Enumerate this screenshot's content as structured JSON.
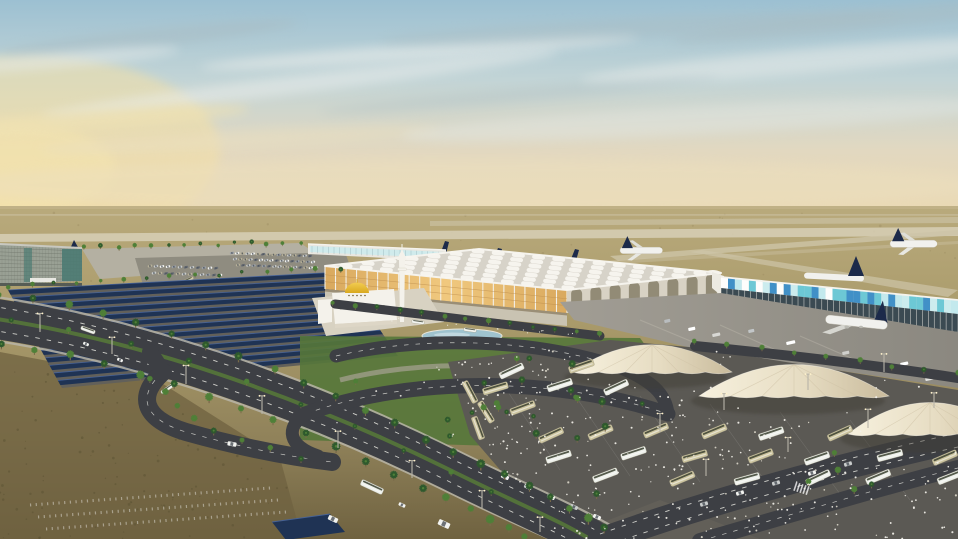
{
  "scene": {
    "description": "Aerial dusk rendering of a new airport complex: large terminal with skylight-grid roof, golden-domed mosque, glass concourses with parked airliners, solar carport parking field, white fabric tent canopies, bus terminal crowded with pilgrims, and palm-lined boulevards through desert terrain",
    "landmarks": [
      "sky",
      "desert",
      "runways",
      "hotel-building",
      "northwest-concourse",
      "main-terminal",
      "terminal-skylight-roof",
      "mosque",
      "minaret",
      "east-concourse",
      "apron",
      "aircraft",
      "solar-carport-field",
      "tent-canopies",
      "bus-terminal",
      "boulevard",
      "palm-trees",
      "pilgrim-crowds",
      "pond"
    ],
    "counts": {
      "tents": 3,
      "aircraft_full": 3,
      "aircraft_tail_fins": 4,
      "solar_rows": 13,
      "skylight_rows": 7,
      "skylight_cols": 12,
      "mosaic_cells": 34,
      "facade_columns": 24,
      "arcade_arches": 8,
      "people_dots": 300,
      "desert_speckles": 150
    },
    "colors": {
      "sky_top": "#9cc0d2",
      "sky_mid": "#c2d4d6",
      "sky_warm": "#e2d8c0",
      "sky_horizon": "#ead9b4",
      "sun_glow": "#f4e0a4",
      "cloud_light": "#e8ecea",
      "cloud_gray": "#a9bcc2",
      "cloud_warm": "#f0e2b2",
      "desert_far": "#b9aa7c",
      "desert_mid": "#a99a6a",
      "desert_low": "#90825a",
      "desert_fore": "#6f6240",
      "desert_speck": "#5d5334",
      "speck_mid": "#8a7c52",
      "runway_strip": "#cdc4a8",
      "runway_light": "#d9d2ba",
      "lot_gray": "#b4b0a2",
      "pad_gray": "#8f8c80",
      "apron_light": "#a19d94",
      "apron_dark": "#8b8880",
      "asphalt": "#5b5954",
      "road": "#3d3f44",
      "road_line": "#e9e9e2",
      "sidewalk": "#b9b5a8",
      "solar_pad": "#62605a",
      "solar_dark": "#1f3354",
      "solar_hi": "#48659c",
      "palm_dark": "#2e5a2d",
      "palm_light": "#4f8038",
      "palm_trunk": "#7a6a4a",
      "grass": "#55773a",
      "pond": "#9fc3cf",
      "pond_edge": "#eae6da",
      "terminal_roof": "#d7d3c9",
      "roof_rim": "#f5f3ed",
      "skylight": "#f8f6f0",
      "facade_glow": "#d9a95e",
      "facade_glow2": "#f0c87e",
      "column_white": "#f2f0e9",
      "facade_line": "#b9894a",
      "arcade_wall": "#d8d2c4",
      "arcade_shadow": "#867f68",
      "mosaic_teal": "#5fc4d4",
      "mosaic_blue": "#2f86c4",
      "mosaic_pale": "#c9ecef",
      "concourse_dark": "#3b4a52",
      "concourse_white": "#e9e7e0",
      "connector_white": "#eceae2",
      "dome_gold": "#d9a91f",
      "dome_gold_hi": "#f2cc52",
      "mosque_white": "#f4f2eb",
      "mosque_shade": "#ddd6c6",
      "minaret_shade": "#d8d2c2",
      "plane_white": "#f1f1ee",
      "plane_tail": "#1c2a4a",
      "plane_gray": "#d6d6d0",
      "tent_light": "#f7f1de",
      "tent_mid": "#e6dcc2",
      "tent_dark": "#c9bb9c",
      "tent_seam": "#cfc2a6",
      "tent_shadow": "#3f3d36",
      "bus_olive": "#ccc49e",
      "bus_white": "#ecefe9",
      "bus_window": "#39402f",
      "bus_edge": "#9a9682",
      "vehicle_white": "#f2f3f0",
      "vehicle_silver": "#c9cccc",
      "people_white": "#f3f1ea",
      "people_dim": "#d9d5c8",
      "pole": "#b8b4a8",
      "pole_glow": "#fff2cc",
      "hotel_face": "#99a094",
      "hotel_glass": "#4b7a72",
      "hotel_line": "#6f756b",
      "hotel_dark": "#565c55"
    }
  }
}
